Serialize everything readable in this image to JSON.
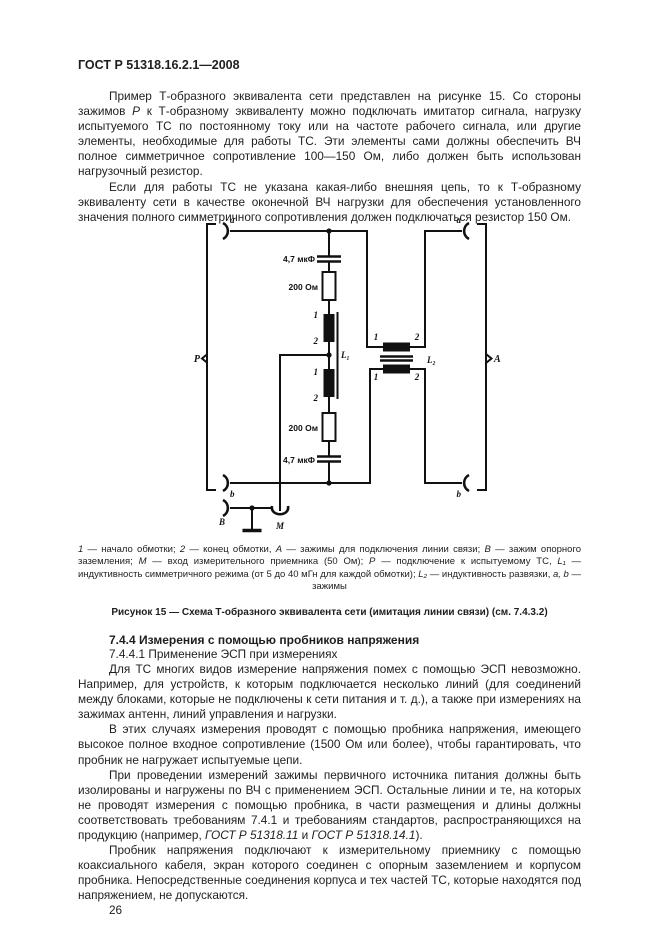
{
  "page": {
    "header": "ГОСТ Р 51318.16.2.1—2008",
    "page_number": "26"
  },
  "intro": {
    "p1": [
      {
        "t": "Пример Т-образного эквивалента сети представлен на рисунке 15. Со стороны зажимов "
      },
      {
        "t": "Р",
        "i": true
      },
      {
        "t": " к Т-образному эквиваленту можно подключать имитатор сигнала, нагрузку испытуемого ТС по постоянному току или на частоте рабочего сигнала, или другие элементы, необходимые для работы ТС. Эти элементы сами должны обеспечить ВЧ полное симметричное сопротивление 100—150 Ом, либо должен быть использован нагрузочный резистор."
      }
    ],
    "p2": "Если для работы ТС не указана какая-либо внешняя цепь, то к Т-образному эквиваленту сети в качестве оконечной ВЧ нагрузки для обеспечения установленного значения полного симметричного сопротивления должен подключаться резистор 150 Ом."
  },
  "figure": {
    "labels": {
      "a": "a",
      "b": "b",
      "P": "P",
      "A": "A",
      "B": "B",
      "M": "M",
      "one": "1",
      "two": "2",
      "l1": "L₁",
      "l2": "L₂",
      "cap": "4,7 мкФ",
      "res": "200 Ом"
    },
    "legend": [
      {
        "t": "1",
        "i": true
      },
      {
        "t": " — начало обмотки; "
      },
      {
        "t": "2",
        "i": true
      },
      {
        "t": " — конец обмотки, "
      },
      {
        "t": "А",
        "i": true
      },
      {
        "t": " — зажимы для подключения линии связи; "
      },
      {
        "t": "В",
        "i": true
      },
      {
        "t": " — зажим опорного заземления; "
      },
      {
        "t": "М",
        "i": true
      },
      {
        "t": " — вход измерительного приемника (50 Ом); "
      },
      {
        "t": "Р",
        "i": true
      },
      {
        "t": " — подключение к испытуемому ТС, "
      },
      {
        "t": "L₁",
        "i": true
      },
      {
        "t": " — индуктивность симметричного режима (от 5 до 40 мГн для каждой обмотки); "
      },
      {
        "t": "L₂",
        "i": true
      },
      {
        "t": " — индуктивность развязки, "
      },
      {
        "t": "a, b",
        "i": true
      },
      {
        "t": " — зажимы"
      }
    ],
    "caption": "Рисунок 15 — Схема Т-образного эквивалента сети (имитация линии связи) (см. 7.4.3.2)"
  },
  "section": {
    "h1": "7.4.4 Измерения с помощью пробников напряжения",
    "h2": "7.4.4.1 Применение ЭСП при измерениях",
    "p3": "Для ТС многих видов измерение напряжения помех с помощью ЭСП невозможно. Например, для устройств, к которым подключается несколько линий (для соединений между блоками, которые не подключены к сети питания и т. д.), а также при измерениях на зажимах антенн, линий управления и нагрузки.",
    "p4": "В этих случаях измерения проводят с помощью пробника напряжения, имеющего высокое полное входное сопротивление (1500 Ом или более), чтобы гарантировать, что пробник не нагружает испытуемые цепи.",
    "p5": [
      {
        "t": "При проведении измерений зажимы первичного источника питания должны быть изолированы и нагружены по ВЧ с применением ЭСП. Остальные линии и те, на которых не проводят измерения с помощью пробника, в части размещения и длины должны соответствовать требованиям 7.4.1 и требованиям стандартов, распространяющихся на продукцию (например, "
      },
      {
        "t": "ГОСТ Р 51318.11",
        "i": true
      },
      {
        "t": " и "
      },
      {
        "t": "ГОСТ Р 51318.14.1",
        "i": true
      },
      {
        "t": ")."
      }
    ],
    "p6": "Пробник напряжения подключают к измерительному приемнику с помощью коаксиального кабеля, экран которого соединен с опорным заземлением и корпусом пробника. Непосредственные соединения корпуса и тех частей ТС, которые находятся под напряжением, не допускаются."
  }
}
